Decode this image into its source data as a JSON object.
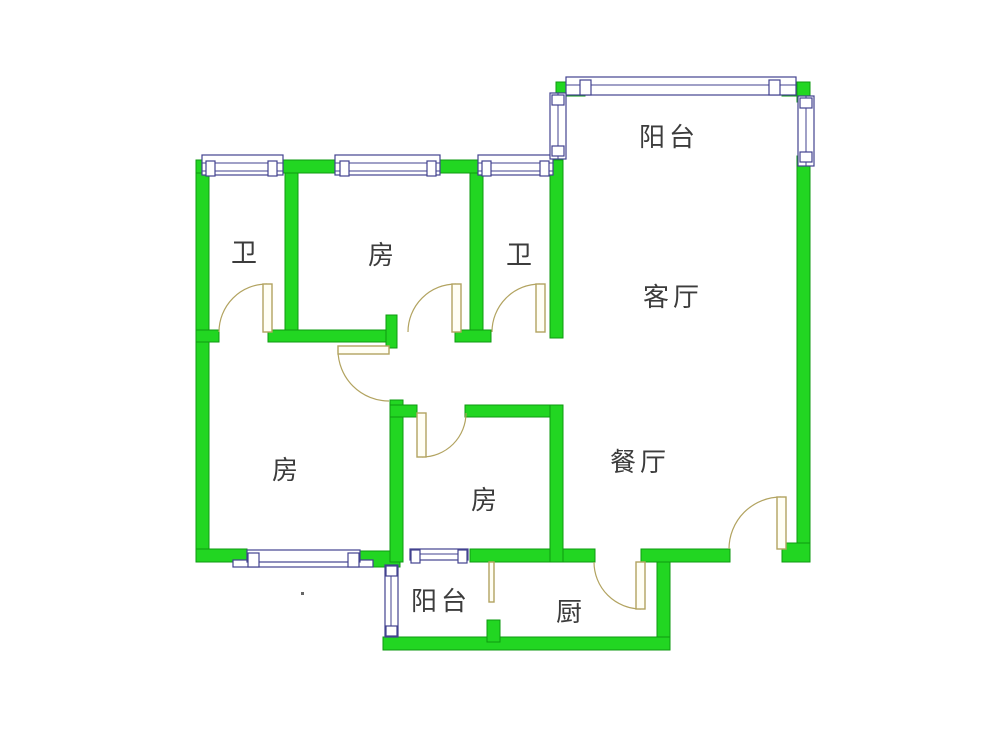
{
  "plan": {
    "title": "residential floor plan",
    "room_count": 10
  },
  "palette": {
    "wall_fill": "#22d622",
    "wall_edge": "#0e9a10",
    "window_fill": "#ffffff",
    "window_edge": "#42428f",
    "door_color": "#b2a360",
    "label_color": "#3c3c3c",
    "background": "#ffffff"
  },
  "rooms": [
    {
      "id": "bath-1",
      "label": "卫"
    },
    {
      "id": "bedroom-top",
      "label": "房"
    },
    {
      "id": "bath-2",
      "label": "卫"
    },
    {
      "id": "balcony-top",
      "label": "阳台"
    },
    {
      "id": "living-room",
      "label": "客厅"
    },
    {
      "id": "bedroom-left",
      "label": "房"
    },
    {
      "id": "bedroom-middle",
      "label": "房"
    },
    {
      "id": "dining-room",
      "label": "餐厅"
    },
    {
      "id": "balcony-bottom",
      "label": "阳台"
    },
    {
      "id": "kitchen",
      "label": "厨"
    }
  ]
}
